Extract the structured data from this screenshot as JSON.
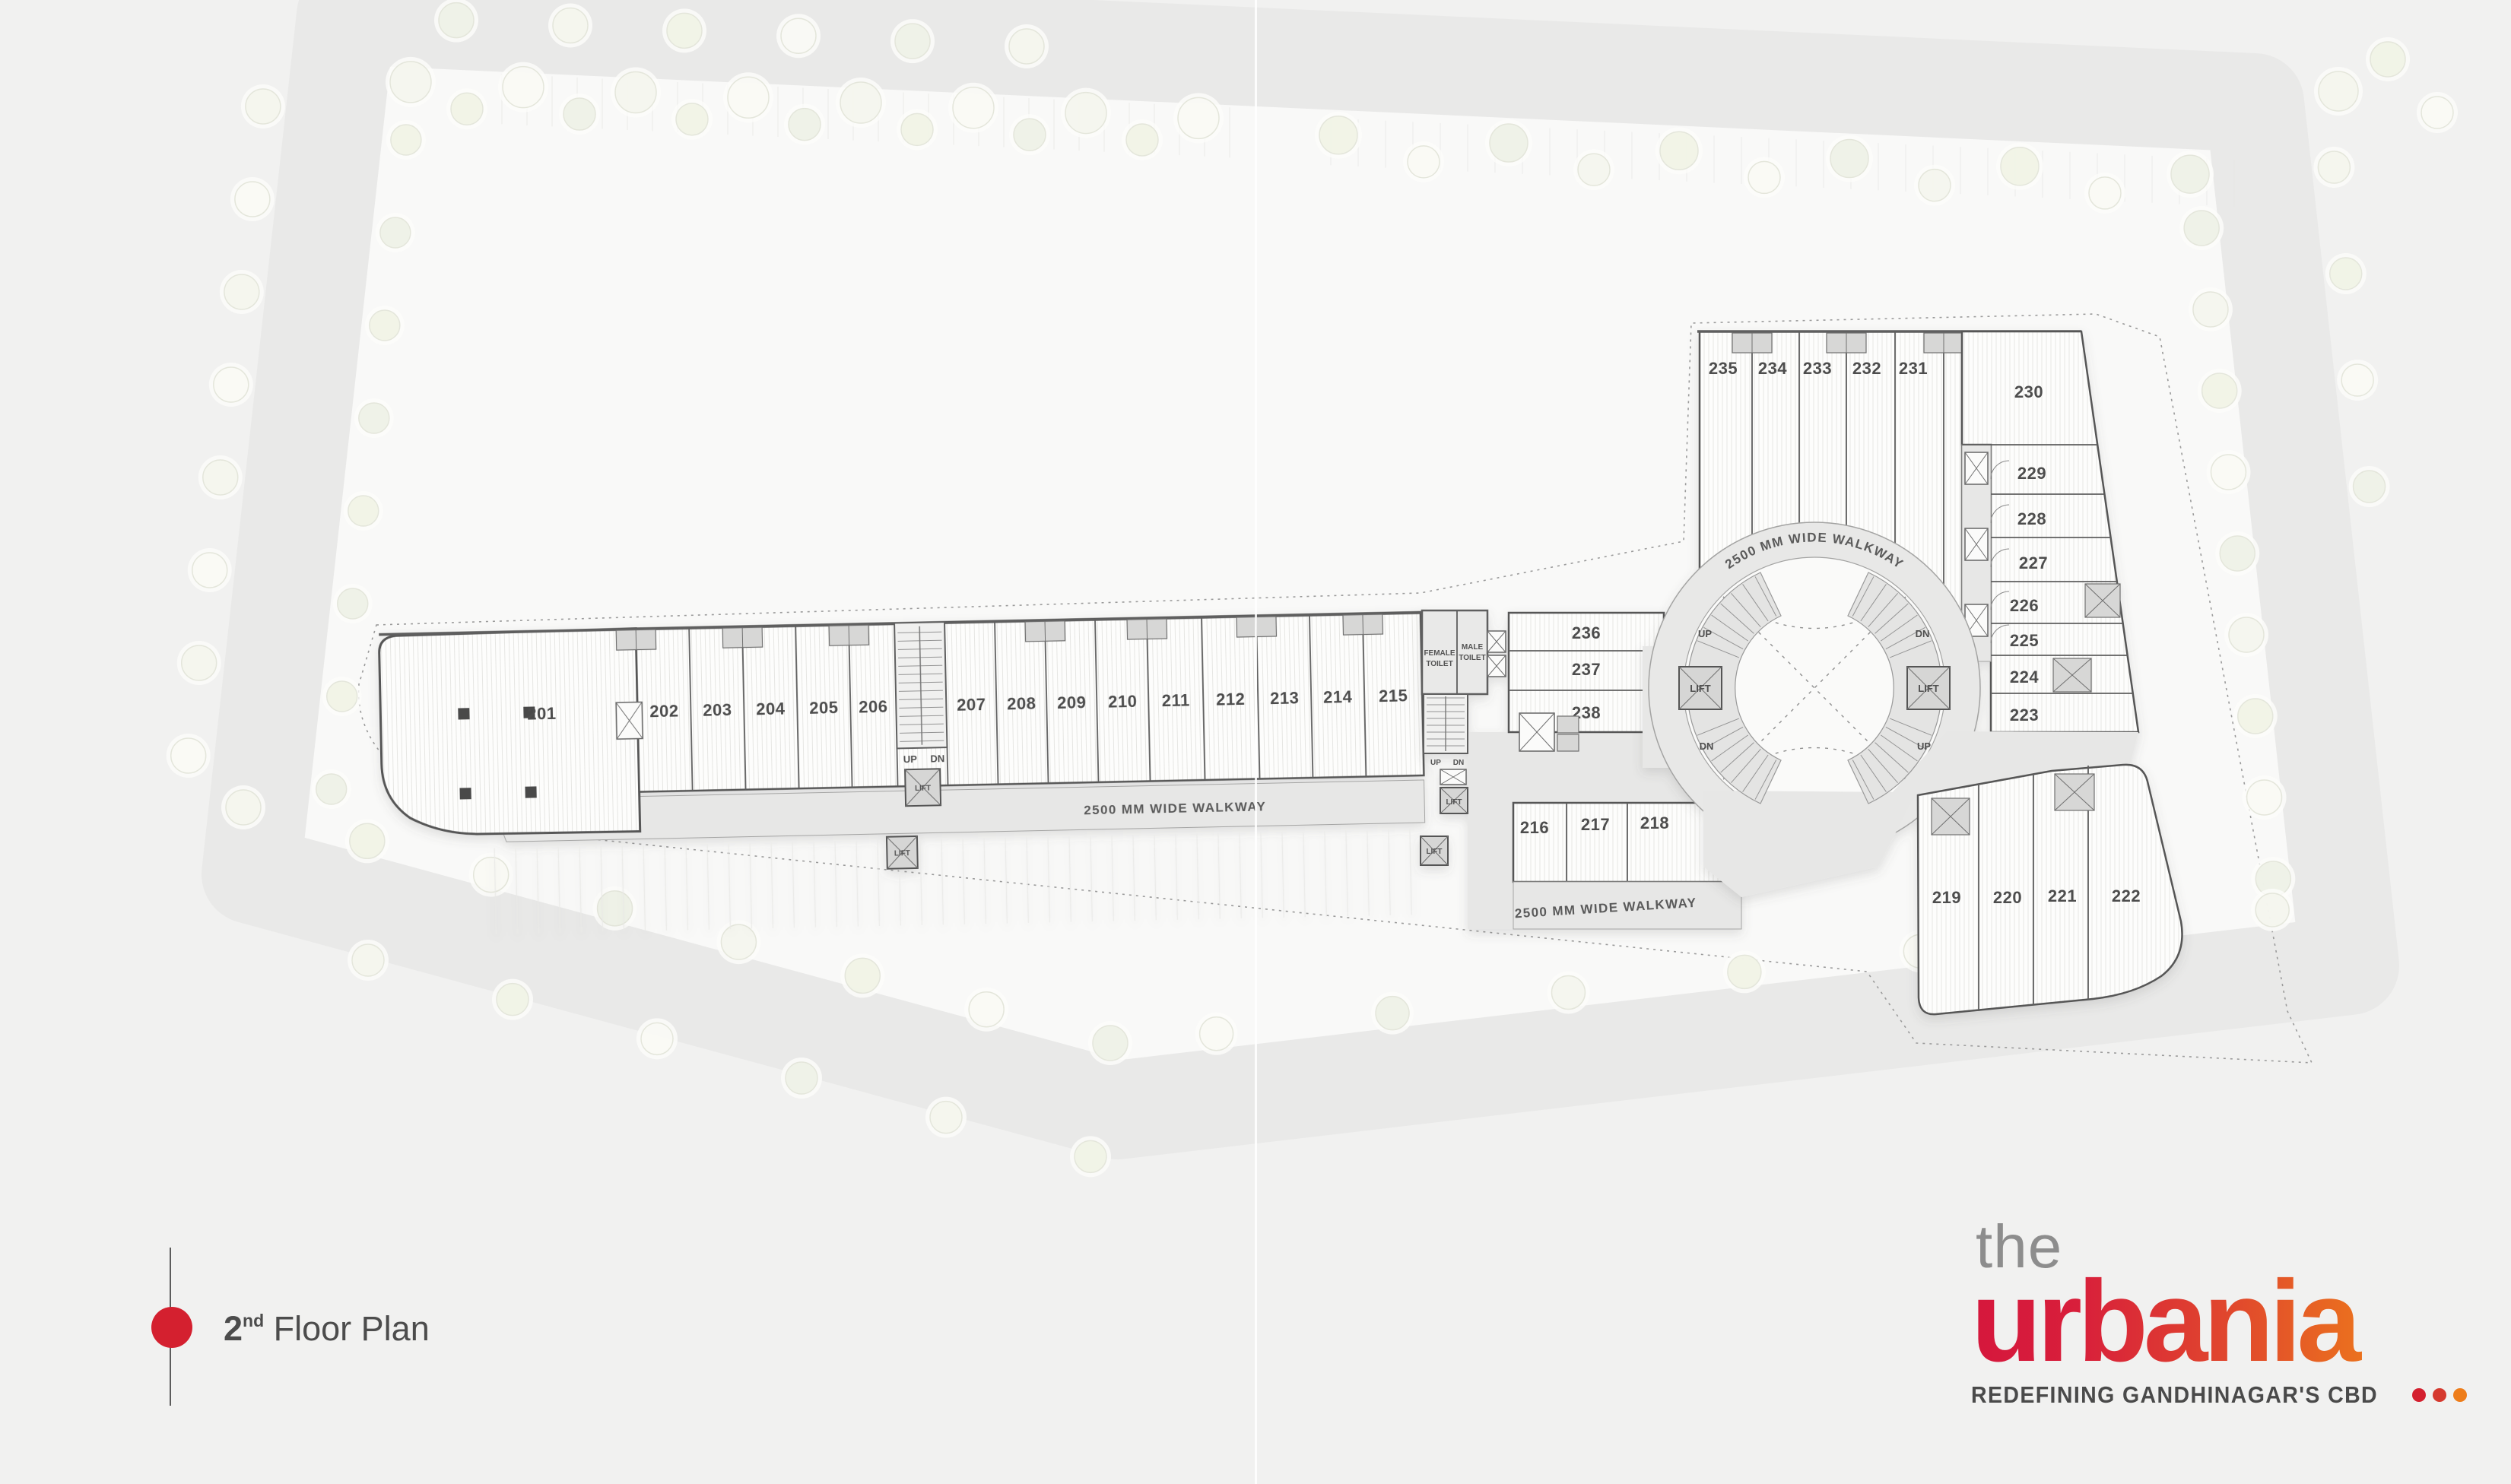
{
  "legend": {
    "floor_number": "2",
    "floor_suffix": "nd",
    "floor_label": " Floor Plan"
  },
  "logo": {
    "line1": "the",
    "line2": "urbania",
    "tagline": "REDEFINING GANDHINAGAR'S CBD"
  },
  "plan": {
    "walkway_label": "2500 MM WIDE WALKWAY",
    "labels": {
      "up": "UP",
      "dn": "DN",
      "lift": "LIFT",
      "female_1": "FEMALE",
      "female_2": "TOILET",
      "male_1": "MALE",
      "male_2": "TOILET"
    },
    "units": {
      "left": [
        "201",
        "202",
        "203",
        "204",
        "205",
        "206",
        "207",
        "208",
        "209",
        "210",
        "211",
        "212",
        "213",
        "214",
        "215"
      ],
      "mid_upper": [
        "236",
        "237",
        "238"
      ],
      "mid_lower": [
        "216",
        "217",
        "218"
      ],
      "top": [
        "235",
        "234",
        "233",
        "232",
        "231"
      ],
      "right_column": [
        "230",
        "229",
        "228",
        "227",
        "226",
        "225",
        "224",
        "223"
      ],
      "bottom_right": [
        "219",
        "220",
        "221",
        "222"
      ]
    }
  },
  "colors": {
    "accent_red": "#d4202f",
    "accent_orange": "#ee7d1a",
    "brand_gradient_start": "#d5173c",
    "brand_gradient_end": "#ee7d1a",
    "text_gray": "#4d4d4d"
  }
}
